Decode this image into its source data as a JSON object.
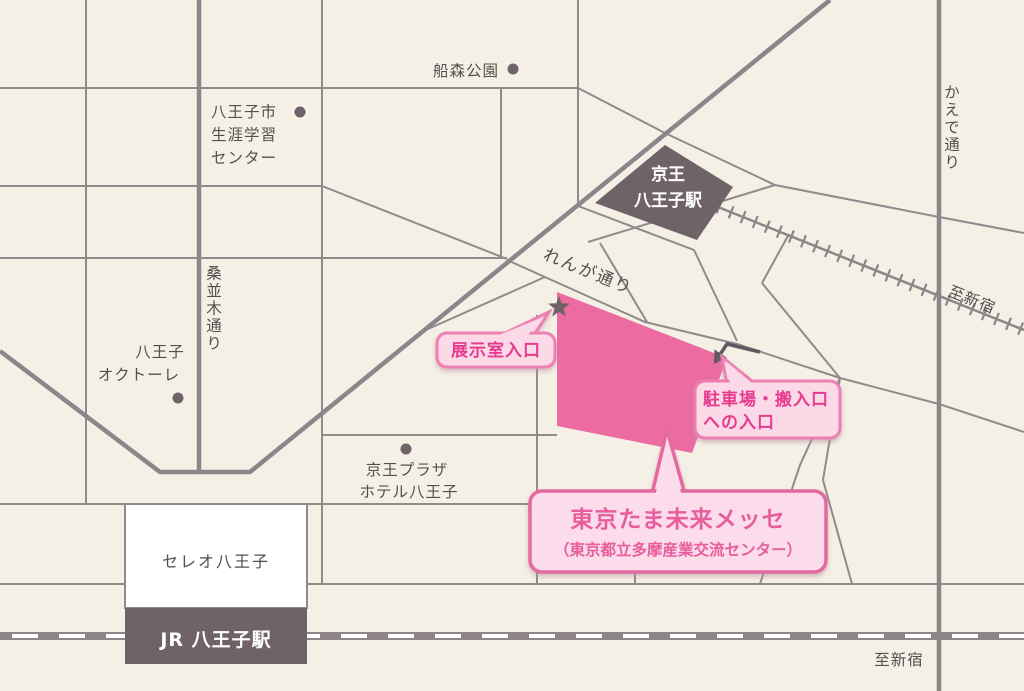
{
  "map": {
    "title_context": "Access map to Tokyo Tama Mirai Messe around Hachioji Station",
    "labels": {
      "funamori_park": "船森公園",
      "learning_center": [
        "八王子市",
        "生涯学習",
        "センター"
      ],
      "kuwanamiki_street": "桑並木通り",
      "octore": [
        "八王子",
        "オクトーレ"
      ],
      "keio_station": [
        "京王",
        "八王子駅"
      ],
      "renga_street": "れんが通り",
      "kaede_street": "かえで通り",
      "to_shinjuku_top": "至新宿",
      "keio_plaza": [
        "京王プラザ",
        "ホテル八王子"
      ],
      "celeo": "セレオ八王子",
      "jr_station": "JR 八王子駅",
      "to_shinjuku_bottom": "至新宿"
    },
    "callouts": {
      "exhibition_entrance": "展示室入口",
      "parking_entrance": [
        "駐車場・搬入口",
        "への入口"
      ],
      "main_building": [
        "東京たま未来メッセ",
        "（東京都立多摩産業交流センター）"
      ]
    },
    "colors": {
      "background": "#f4f0e5",
      "road_gray": "#8d858a",
      "building_dark": "#6f6368",
      "building_pink": "#ec6ba1",
      "callout_fill": "#fbd9e7",
      "callout_border_small": "#ee7fb2",
      "callout_border_main": "#e4699f",
      "callout_text_pink": "#e73a90",
      "label_gray": "#544e50",
      "white": "#ffffff"
    }
  }
}
